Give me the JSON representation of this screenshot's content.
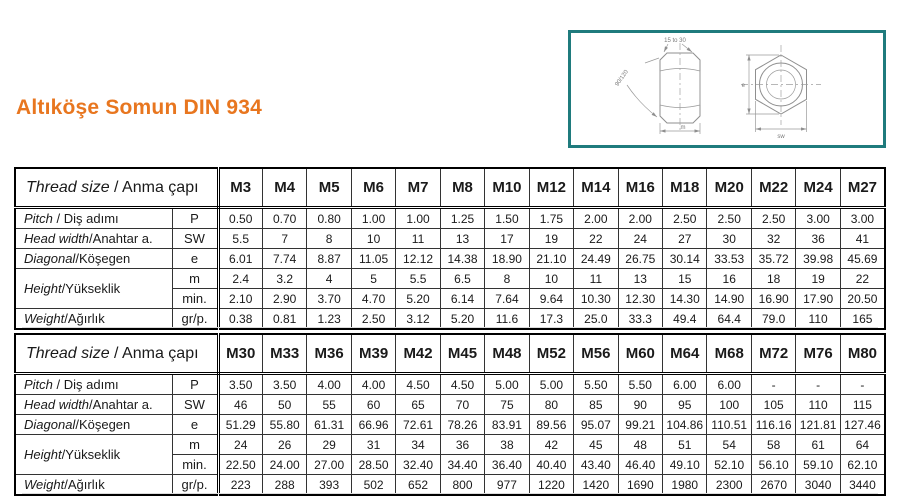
{
  "page": {
    "title": "Altıköşe Somun DIN 934"
  },
  "drawing": {
    "labels": {
      "chamfer_angle": "15 to 30",
      "bevel_angle": "90/120",
      "height_dim": "m",
      "diagonal_dim": "e",
      "width_dim": "sw"
    }
  },
  "colors": {
    "accent_orange": "#E8761F",
    "drawing_border_teal": "#1F7B7D"
  },
  "tables": [
    {
      "header": {
        "en": "Thread size",
        "rest": " / Anma çapı"
      },
      "columns": [
        "M3",
        "M4",
        "M5",
        "M6",
        "M7",
        "M8",
        "M10",
        "M12",
        "M14",
        "M16",
        "M18",
        "M20",
        "M22",
        "M24",
        "M27"
      ],
      "rows": [
        {
          "label": {
            "en": "Pitch",
            "rest": " / Diş adımı"
          },
          "span": 1,
          "unit": "P",
          "values": [
            "0.50",
            "0.70",
            "0.80",
            "1.00",
            "1.00",
            "1.25",
            "1.50",
            "1.75",
            "2.00",
            "2.00",
            "2.50",
            "2.50",
            "2.50",
            "3.00",
            "3.00"
          ]
        },
        {
          "label": {
            "en": "Head width",
            "rest": "/Anahtar a."
          },
          "span": 1,
          "unit": "SW",
          "values": [
            "5.5",
            "7",
            "8",
            "10",
            "11",
            "13",
            "17",
            "19",
            "22",
            "24",
            "27",
            "30",
            "32",
            "36",
            "41"
          ]
        },
        {
          "label": {
            "en": "Diagonal",
            "rest": "/Köşegen"
          },
          "span": 1,
          "unit": "e",
          "values": [
            "6.01",
            "7.74",
            "8.87",
            "11.05",
            "12.12",
            "14.38",
            "18.90",
            "21.10",
            "24.49",
            "26.75",
            "30.14",
            "33.53",
            "35.72",
            "39.98",
            "45.69"
          ]
        },
        {
          "label": {
            "en": "Height",
            "rest": "/Yükseklik"
          },
          "span": 2,
          "unit": "m",
          "values": [
            "2.4",
            "3.2",
            "4",
            "5",
            "5.5",
            "6.5",
            "8",
            "10",
            "11",
            "13",
            "15",
            "16",
            "18",
            "19",
            "22"
          ]
        },
        {
          "label": null,
          "span": 0,
          "unit": "min.",
          "values": [
            "2.10",
            "2.90",
            "3.70",
            "4.70",
            "5.20",
            "6.14",
            "7.64",
            "9.64",
            "10.30",
            "12.30",
            "14.30",
            "14.90",
            "16.90",
            "17.90",
            "20.50"
          ]
        },
        {
          "label": {
            "en": "Weight",
            "rest": "/Ağırlık"
          },
          "span": 1,
          "unit": "gr/p.",
          "values": [
            "0.38",
            "0.81",
            "1.23",
            "2.50",
            "3.12",
            "5.20",
            "11.6",
            "17.3",
            "25.0",
            "33.3",
            "49.4",
            "64.4",
            "79.0",
            "110",
            "165"
          ]
        }
      ]
    },
    {
      "header": {
        "en": "Thread size",
        "rest": " / Anma çapı"
      },
      "columns": [
        "M30",
        "M33",
        "M36",
        "M39",
        "M42",
        "M45",
        "M48",
        "M52",
        "M56",
        "M60",
        "M64",
        "M68",
        "M72",
        "M76",
        "M80"
      ],
      "rows": [
        {
          "label": {
            "en": "Pitch",
            "rest": " / Diş adımı"
          },
          "span": 1,
          "unit": "P",
          "values": [
            "3.50",
            "3.50",
            "4.00",
            "4.00",
            "4.50",
            "4.50",
            "5.00",
            "5.00",
            "5.50",
            "5.50",
            "6.00",
            "6.00",
            "-",
            "-",
            "-"
          ]
        },
        {
          "label": {
            "en": "Head width",
            "rest": "/Anahtar a."
          },
          "span": 1,
          "unit": "SW",
          "values": [
            "46",
            "50",
            "55",
            "60",
            "65",
            "70",
            "75",
            "80",
            "85",
            "90",
            "95",
            "100",
            "105",
            "110",
            "115"
          ]
        },
        {
          "label": {
            "en": "Diagonal",
            "rest": "/Köşegen"
          },
          "span": 1,
          "unit": "e",
          "values": [
            "51.29",
            "55.80",
            "61.31",
            "66.96",
            "72.61",
            "78.26",
            "83.91",
            "89.56",
            "95.07",
            "99.21",
            "104.86",
            "110.51",
            "116.16",
            "121.81",
            "127.46"
          ]
        },
        {
          "label": {
            "en": "Height",
            "rest": "/Yükseklik"
          },
          "span": 2,
          "unit": "m",
          "values": [
            "24",
            "26",
            "29",
            "31",
            "34",
            "36",
            "38",
            "42",
            "45",
            "48",
            "51",
            "54",
            "58",
            "61",
            "64"
          ]
        },
        {
          "label": null,
          "span": 0,
          "unit": "min.",
          "values": [
            "22.50",
            "24.00",
            "27.00",
            "28.50",
            "32.40",
            "34.40",
            "36.40",
            "40.40",
            "43.40",
            "46.40",
            "49.10",
            "52.10",
            "56.10",
            "59.10",
            "62.10"
          ]
        },
        {
          "label": {
            "en": "Weight",
            "rest": "/Ağırlık"
          },
          "span": 1,
          "unit": "gr/p.",
          "values": [
            "223",
            "288",
            "393",
            "502",
            "652",
            "800",
            "977",
            "1220",
            "1420",
            "1690",
            "1980",
            "2300",
            "2670",
            "3040",
            "3440"
          ]
        }
      ]
    }
  ]
}
